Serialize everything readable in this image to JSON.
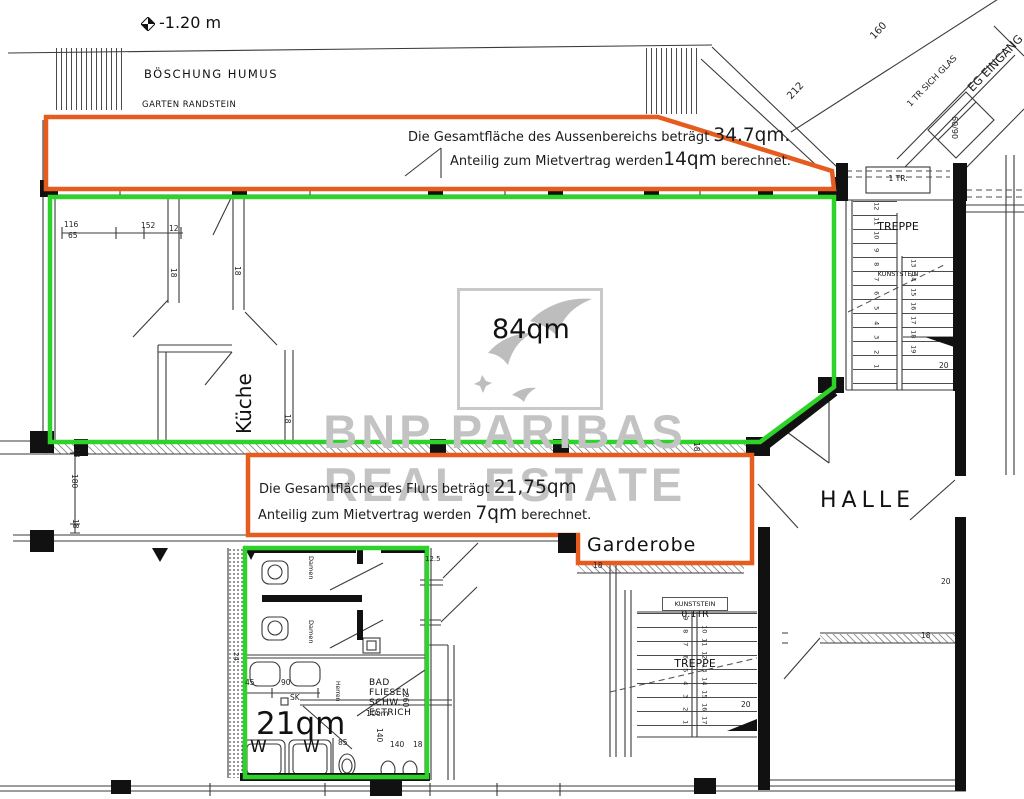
{
  "colors": {
    "green": "#2ed32a",
    "orange": "#e65c1e",
    "watermark_gray": "#c3c3c3",
    "line_dark": "#111111"
  },
  "site": {
    "elevation": "-1.20 m",
    "slope": "BÖSCHUNG HUMUS",
    "garden": "GARTEN RANDSTEIN"
  },
  "notes": {
    "aussen": {
      "l1a": "Die Gesamtfläche des Aussenbereichs beträgt ",
      "l1b": "34.7qm.",
      "l2a": "Anteilig zum Mietvertrag werden",
      "l2b": "14qm",
      "l2c": " berechnet."
    },
    "flur": {
      "l1a": "Die Gesamtfläche des Flurs beträgt ",
      "l1b": "21,75qm",
      "l2a": "Anteilig zum Mietvertrag werden ",
      "l2b": "7qm",
      "l2c": " berechnet."
    }
  },
  "areas": {
    "main": "84qm",
    "bath": "21qm"
  },
  "rooms": {
    "kueche": "Küche",
    "halle": "HALLE",
    "garderobe": "Garderobe",
    "damen": "Damen",
    "herren": "Herren",
    "sink": "W",
    "bad": [
      "BAD",
      "FLIESEN",
      "SCHW.",
      "ESTRICH"
    ]
  },
  "stair_right": {
    "size": "1 TR.",
    "name": "TREPPE",
    "material": "KUNSTSTEIN",
    "run1": [
      "12",
      "11",
      "10",
      "9",
      "8",
      "7",
      "6",
      "5",
      "4",
      "3",
      "2",
      "1"
    ],
    "run2": [
      "13",
      "14",
      "15",
      "16",
      "17",
      "18",
      "19"
    ]
  },
  "stair_bottom": {
    "size": "0.1TR",
    "name": "TREPPE",
    "material": "KUNSTSTEIN",
    "run1": [
      "9",
      "8",
      "7",
      "6",
      "5",
      "4",
      "3",
      "2",
      "1"
    ],
    "run2": [
      "10",
      "11",
      "12",
      "13",
      "14",
      "15",
      "16",
      "17"
    ]
  },
  "watermark": {
    "line1": "BNP PARIBAS",
    "line2": "REAL ESTATE"
  },
  "dim_labels": [
    {
      "t": "116",
      "x": 64,
      "y": 221
    },
    {
      "t": "65",
      "x": 68,
      "y": 232
    },
    {
      "t": "152",
      "x": 141,
      "y": 222
    },
    {
      "t": "12",
      "x": 169,
      "y": 225
    },
    {
      "t": "18",
      "x": 177,
      "y": 268,
      "r": 90
    },
    {
      "t": "18",
      "x": 241,
      "y": 266,
      "r": 90
    },
    {
      "t": "18",
      "x": 291,
      "y": 414,
      "r": 90
    },
    {
      "t": "18",
      "x": 80,
      "y": 448,
      "r": 90
    },
    {
      "t": "180",
      "x": 78,
      "y": 474,
      "r": 90
    },
    {
      "t": "18",
      "x": 79,
      "y": 519,
      "r": 90
    },
    {
      "t": "18",
      "x": 700,
      "y": 442,
      "r": 90
    },
    {
      "t": "212",
      "x": 786,
      "y": 95,
      "r": -47,
      "fs": 10
    },
    {
      "t": "160",
      "x": 869,
      "y": 35,
      "r": -47,
      "fs": 10
    },
    {
      "t": "1 TR SICH GLAS",
      "x": 906,
      "y": 103,
      "r": -46,
      "fs": 8.5
    },
    {
      "t": "EG EINGANG",
      "x": 966,
      "y": 86,
      "r": -46,
      "fs": 11.5
    },
    {
      "t": "60/90",
      "x": 958,
      "y": 116,
      "r": 90,
      "fs": 8
    },
    {
      "t": "20",
      "x": 939,
      "y": 362
    },
    {
      "t": "20",
      "x": 941,
      "y": 578
    },
    {
      "t": "20",
      "x": 741,
      "y": 701
    },
    {
      "t": "18",
      "x": 921,
      "y": 632
    },
    {
      "t": "45",
      "x": 245,
      "y": 679
    },
    {
      "t": "90",
      "x": 281,
      "y": 679
    },
    {
      "t": "SK",
      "x": 290,
      "y": 694
    },
    {
      "t": "10cm",
      "x": 366,
      "y": 710,
      "fs": 8
    },
    {
      "t": "85",
      "x": 338,
      "y": 739
    },
    {
      "t": "140",
      "x": 383,
      "y": 728,
      "r": 90
    },
    {
      "t": "140",
      "x": 390,
      "y": 741
    },
    {
      "t": "18",
      "x": 413,
      "y": 741
    },
    {
      "t": "260",
      "x": 409,
      "y": 693,
      "r": 90
    },
    {
      "t": "12.5",
      "x": 425,
      "y": 556,
      "fs": 7
    },
    {
      "t": "18",
      "x": 593,
      "y": 562
    },
    {
      "t": "24",
      "x": 239,
      "y": 652,
      "r": 90,
      "fs": 7
    }
  ]
}
